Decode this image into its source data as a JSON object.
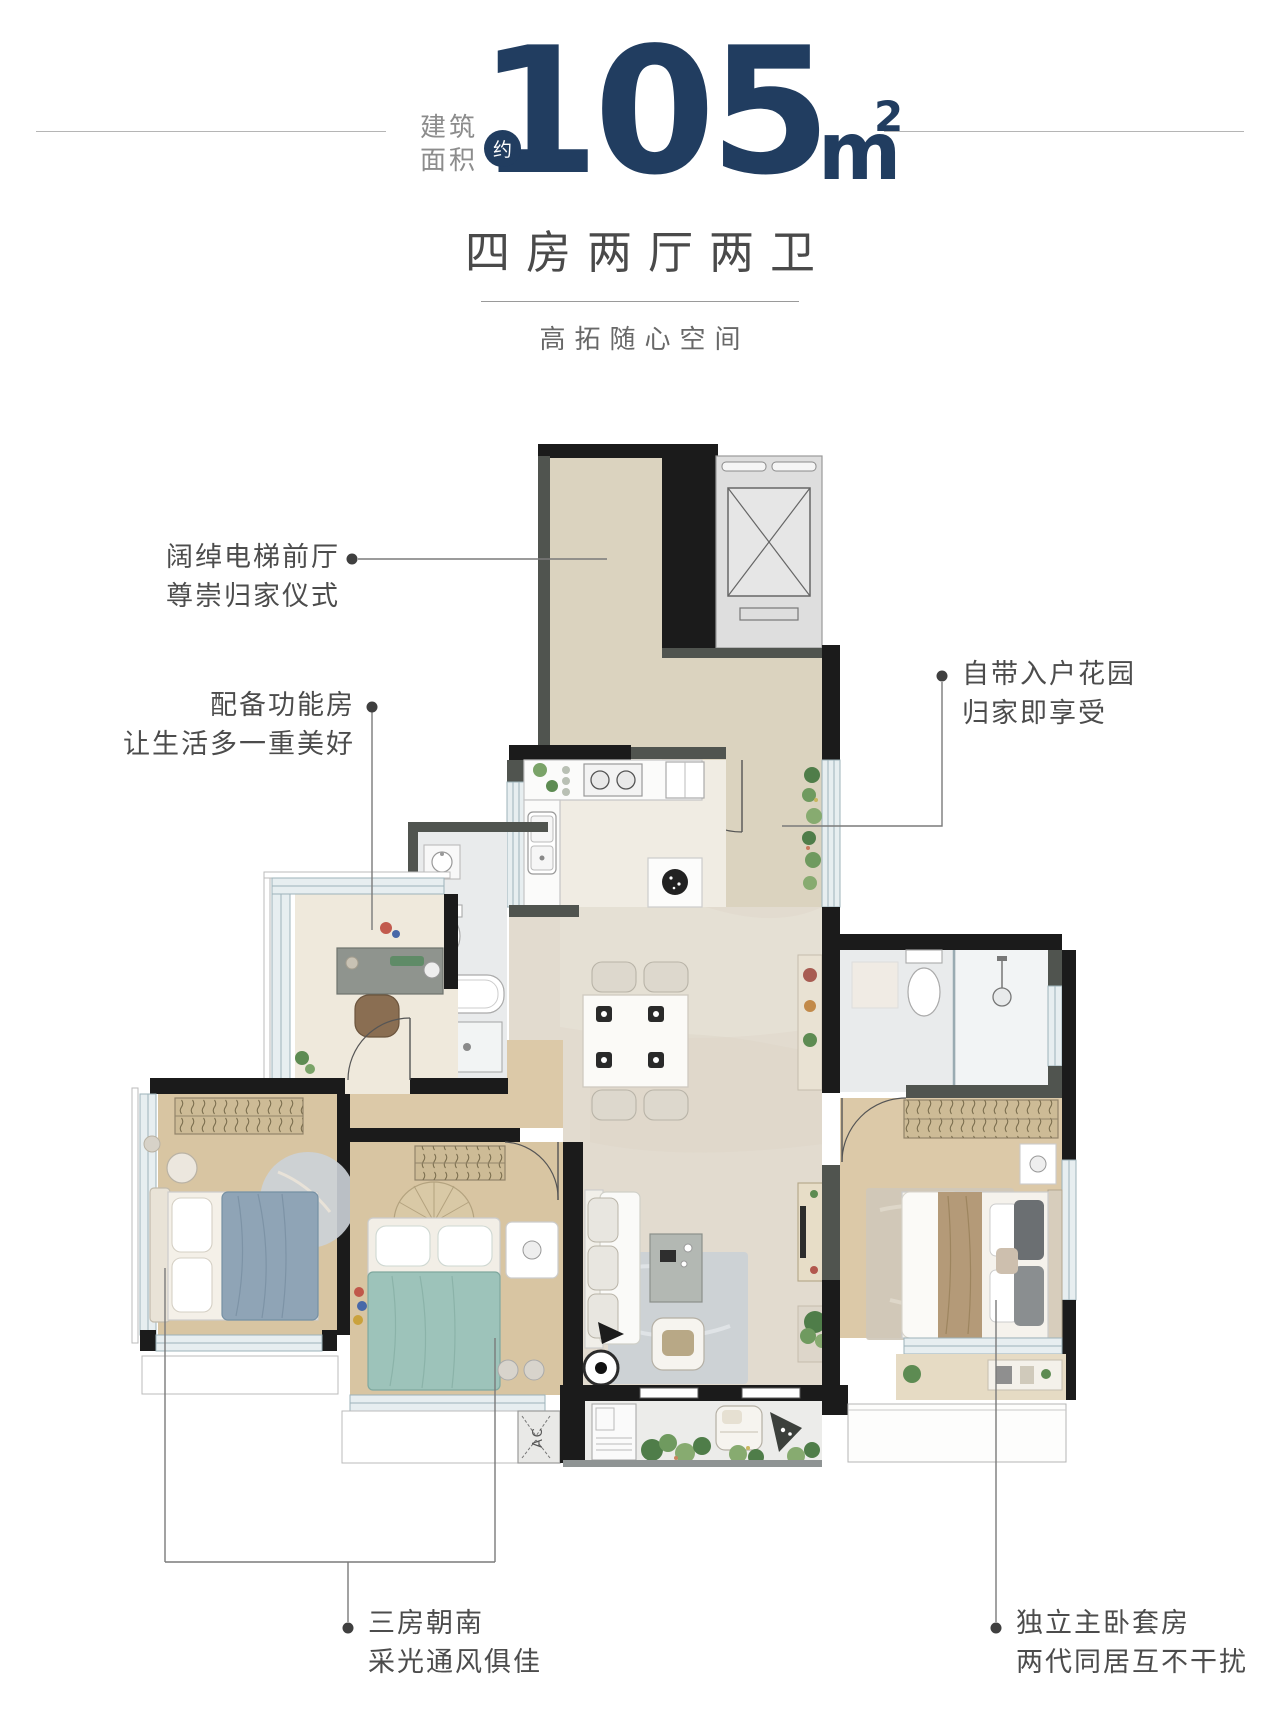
{
  "header": {
    "area_label_line1": "建筑",
    "area_label_line2": "面积",
    "approx_badge": "约",
    "area_number": "105",
    "area_unit": "m",
    "area_unit_sup": "2",
    "accent_color": "#213d60"
  },
  "subtitle": {
    "title": "四房两厅两卫",
    "tagline": "高拓随心空间"
  },
  "annotations": {
    "lobby": {
      "line1": "阔绰电梯前厅",
      "line2": "尊崇归家仪式"
    },
    "function_room": {
      "line1": "配备功能房",
      "line2": "让生活多一重美好"
    },
    "entry_garden": {
      "line1": "自带入户花园",
      "line2": "归家即享受"
    },
    "south_rooms": {
      "line1": "三房朝南",
      "line2": "采光通风俱佳"
    },
    "master_suite": {
      "line1": "独立主卧套房",
      "line2": "两代同居互不干扰"
    }
  },
  "plan": {
    "ac_label": "AC",
    "colors": {
      "wall": "#1b1b1b",
      "wall_gray": "#50544f",
      "floor_beige": "#e2dbcf",
      "floor_corridor": "#dbd3bf",
      "floor_wood": "#d8c5a2",
      "bath_marble": "#e9ebec",
      "glass": "#e7eef0",
      "bed_teal": "#9dc3ba",
      "bed_blue": "#8fa4b6",
      "bed_tan": "#b49a78",
      "plant_green": "#4f7d49",
      "leader": "#7a7a7a"
    }
  }
}
